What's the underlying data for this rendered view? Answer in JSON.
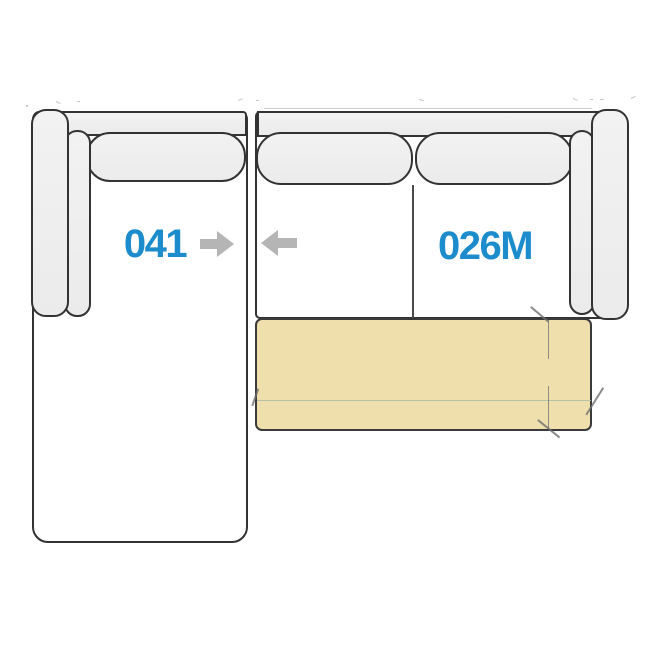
{
  "diagram": {
    "type": "sectional-sofa-plan-schematic",
    "colors": {
      "background": "#ffffff",
      "outline": "#333333",
      "fill_light_top": "#f2f2f2",
      "fill_light": "#ebebeb",
      "body_fill": "#ffffff",
      "mattress_fill": "#efdfac",
      "label_blue": "#1d8ccd",
      "arrow_gray": "#b5b5b5",
      "fold_line": "#aebfa8",
      "mark_gray": "#6f6f6f",
      "artifact_gray": "#9a9a9a"
    },
    "modules": [
      {
        "id": "chaise-left-arm",
        "label": "041",
        "connector": "arrow-right",
        "parts": [
          "armrest-left",
          "arm-cushion",
          "back-frame",
          "back-cushion",
          "chaise-seat"
        ]
      },
      {
        "id": "sofa-right-arm-sleeper",
        "label": "026M",
        "connector": "arrow-left",
        "parts": [
          "back-frame",
          "back-cushion-1",
          "back-cushion-2",
          "seat-divider",
          "arm-cushion",
          "armrest-right",
          "fold-out-mattress"
        ]
      }
    ]
  }
}
